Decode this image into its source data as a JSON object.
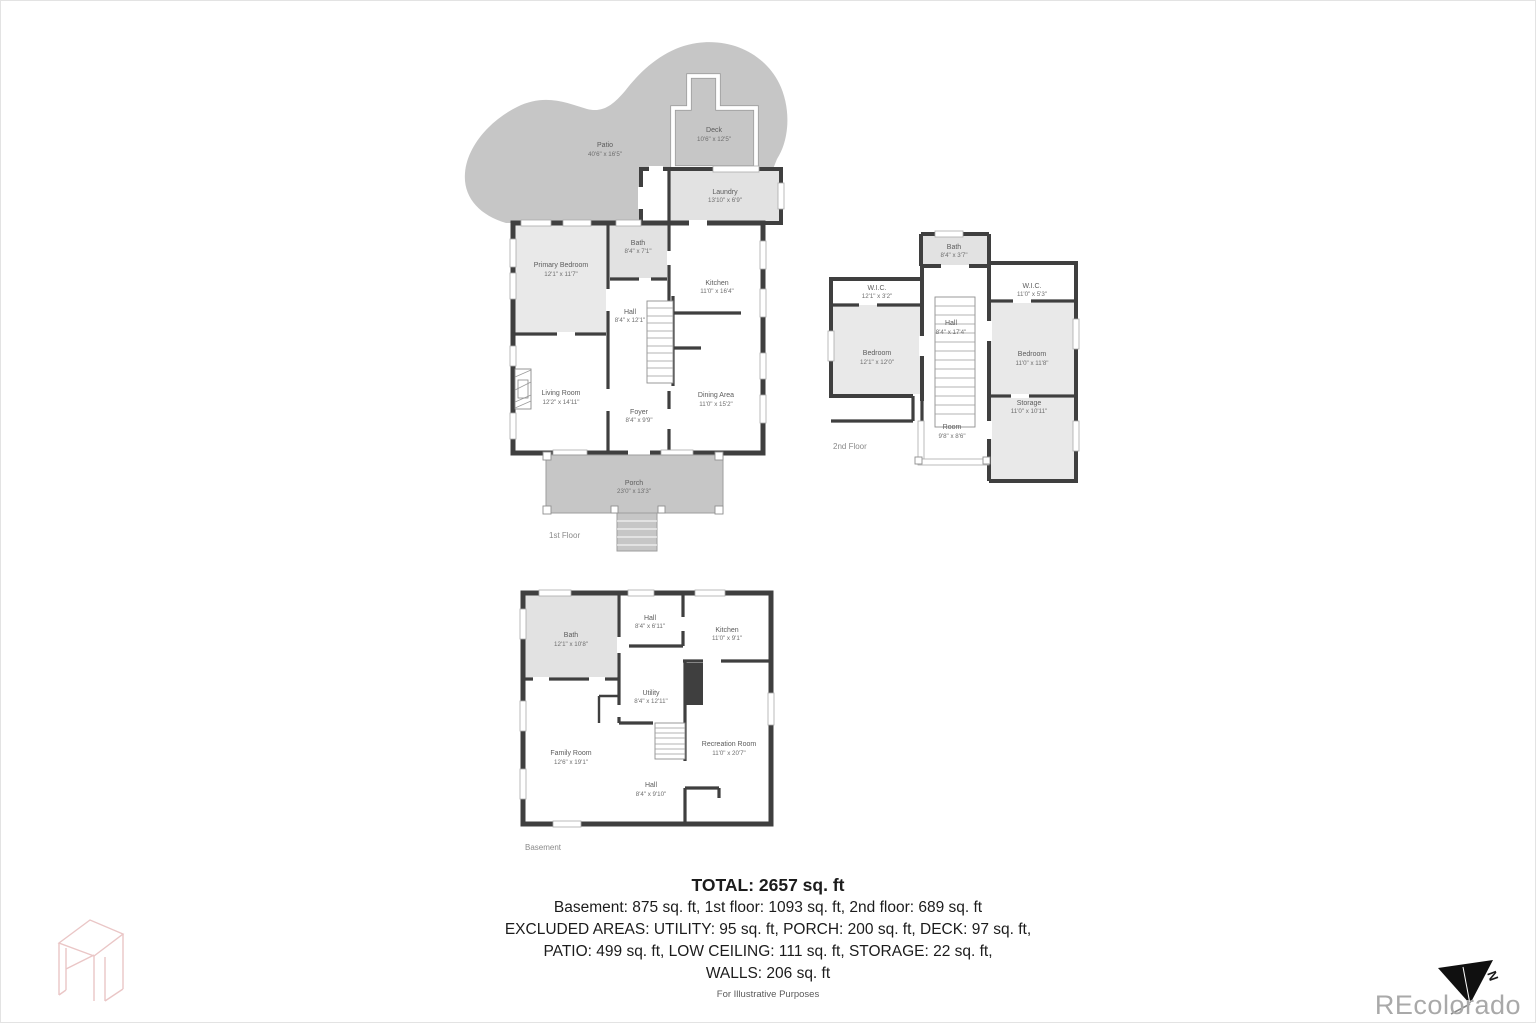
{
  "colors": {
    "wall": "#3f3f3f",
    "outdoor": "#c6c6c6",
    "roomfill": "#e9e9e9",
    "roomfill2": "#e2e2e2",
    "watermark": "#a9a9a9",
    "logo": "#eac6c6"
  },
  "floors": [
    {
      "label": "1st Floor",
      "rooms": [
        {
          "name": "Patio",
          "dims": "40'6\" x 16'5\""
        },
        {
          "name": "Deck",
          "dims": "10'6\" x 12'5\""
        },
        {
          "name": "Laundry",
          "dims": "13'10\" x 6'9\""
        },
        {
          "name": "Primary Bedroom",
          "dims": "12'1\" x 11'7\""
        },
        {
          "name": "Bath",
          "dims": "8'4\" x 7'1\""
        },
        {
          "name": "Kitchen",
          "dims": "11'0\" x 16'4\""
        },
        {
          "name": "Hall",
          "dims": "8'4\" x 12'1\""
        },
        {
          "name": "Living Room",
          "dims": "12'2\" x 14'11\""
        },
        {
          "name": "Foyer",
          "dims": "8'4\" x 9'9\""
        },
        {
          "name": "Dining Area",
          "dims": "11'0\" x 15'2\""
        },
        {
          "name": "Porch",
          "dims": "23'0\" x 13'3\""
        }
      ]
    },
    {
      "label": "2nd Floor",
      "rooms": [
        {
          "name": "Bath",
          "dims": "8'4\" x 3'7\""
        },
        {
          "name": "W.I.C.",
          "dims": "12'1\" x 3'2\""
        },
        {
          "name": "Bedroom",
          "dims": "12'1\" x 12'0\""
        },
        {
          "name": "Hall",
          "dims": "8'4\" x 17'4\""
        },
        {
          "name": "W.I.C.",
          "dims": "11'0\" x 5'3\""
        },
        {
          "name": "Bedroom",
          "dims": "11'0\" x 11'8\""
        },
        {
          "name": "Storage",
          "dims": "11'0\" x 10'11\""
        },
        {
          "name": "Room",
          "dims": "9'8\" x 8'6\""
        }
      ]
    },
    {
      "label": "Basement",
      "rooms": [
        {
          "name": "Bath",
          "dims": "12'1\" x 10'8\""
        },
        {
          "name": "Hall",
          "dims": "8'4\" x 6'11\""
        },
        {
          "name": "Kitchen",
          "dims": "11'0\" x 9'1\""
        },
        {
          "name": "Utility",
          "dims": "8'4\" x 12'11\""
        },
        {
          "name": "Family Room",
          "dims": "12'6\" x 19'1\""
        },
        {
          "name": "Recreation Room",
          "dims": "11'0\" x 20'7\""
        },
        {
          "name": "Hall",
          "dims": "8'4\" x 9'10\""
        }
      ]
    }
  ],
  "summary": {
    "total": "TOTAL: 2657 sq. ft",
    "line1": "Basement: 875 sq. ft, 1st floor: 1093 sq. ft, 2nd floor: 689 sq. ft",
    "line2": "EXCLUDED AREAS: UTILITY: 95 sq. ft, PORCH: 200 sq. ft, DECK: 97 sq. ft,",
    "line3": "PATIO: 499 sq. ft, LOW CEILING: 111 sq. ft, STORAGE: 22 sq. ft,",
    "line4": "WALLS: 206 sq. ft",
    "disclaimer": "For Illustrative Purposes"
  },
  "watermark": "REcolorado",
  "compass": {
    "label": "N"
  }
}
